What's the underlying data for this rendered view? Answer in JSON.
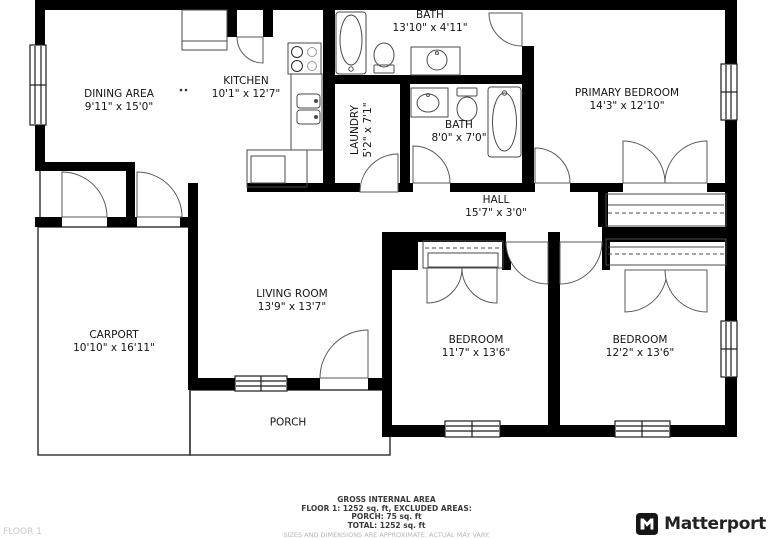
{
  "floorplan": {
    "rooms": [
      {
        "id": "dining",
        "name": "DINING AREA",
        "dims": "9'11\" x 15'0\""
      },
      {
        "id": "kitchen",
        "name": "KITCHEN",
        "dims": "10'1\" x 12'7\""
      },
      {
        "id": "bath-top",
        "name": "BATH",
        "dims": "13'10\" x 4'11\""
      },
      {
        "id": "primary-bedroom",
        "name": "PRIMARY BEDROOM",
        "dims": "14'3\" x 12'10\""
      },
      {
        "id": "laundry",
        "name": "LAUNDRY",
        "dims": "5'2\" x 7'1\""
      },
      {
        "id": "bath-hall",
        "name": "BATH",
        "dims": "8'0\" x 7'0\""
      },
      {
        "id": "hall",
        "name": "HALL",
        "dims": "15'7\" x 3'0\""
      },
      {
        "id": "living-room",
        "name": "LIVING ROOM",
        "dims": "13'9\" x 13'7\""
      },
      {
        "id": "carport",
        "name": "CARPORT",
        "dims": "10'10\" x 16'11\""
      },
      {
        "id": "bedroom-1",
        "name": "BEDROOM",
        "dims": "11'7\" x 13'6\""
      },
      {
        "id": "bedroom-2",
        "name": "BEDROOM",
        "dims": "12'2\" x 13'6\""
      },
      {
        "id": "porch",
        "name": "PORCH",
        "dims": ""
      }
    ]
  },
  "footer": {
    "summary_title": "GROSS INTERNAL AREA",
    "summary_lines": [
      "FLOOR 1: 1252 sq. ft, EXCLUDED AREAS:",
      "PORCH: 75 sq. ft",
      "TOTAL: 1252 sq. ft"
    ],
    "disclaimer": "SIZES AND DIMENSIONS ARE APPROXIMATE. ACTUAL MAY VARY.",
    "floor_label": "FLOOR 1",
    "brand_name": "Matterport"
  },
  "colors": {
    "wall": "#000000",
    "fixture_line": "#4a4a4a",
    "brand_text": "#222222",
    "muted_text": "#b5b5b5"
  }
}
